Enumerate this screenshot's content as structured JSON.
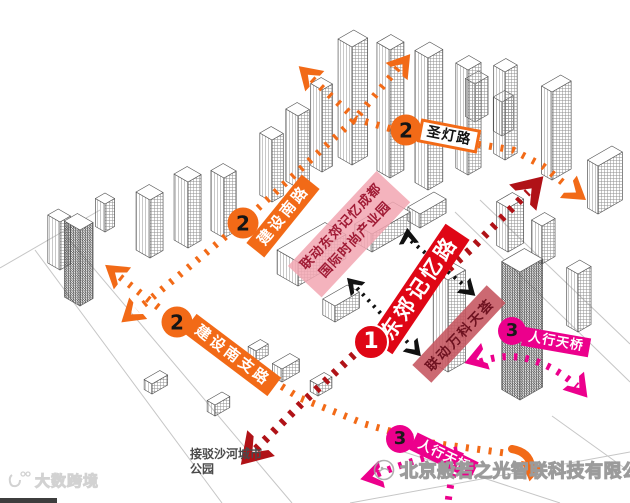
{
  "colors": {
    "orange": "#F26A17",
    "bright_red": "#DF0615",
    "dark_red": "#B01217",
    "magenta": "#EC008C",
    "banner_pink_bg": "#F2A6B1",
    "banner_pink_text": "#A01B35",
    "banner_vanke_bg": "#C5545E",
    "banner_vanke_text": "#6E1220",
    "note_gray": "#4A4A4A",
    "black_route": "#111111"
  },
  "routes": {
    "route1": {
      "number": "1",
      "road_label": "东郊记忆路"
    },
    "route2": {
      "number": "2",
      "roads": {
        "jianshe_south": "建设南路",
        "shengdeng": "圣灯路",
        "jianshe_south_branch": "建设南支路"
      }
    },
    "route3": {
      "number": "3",
      "label": "人行天桥"
    }
  },
  "banners": {
    "dongjiao_park_line1": "联动东郊记忆成都",
    "dongjiao_park_line2": "国际时尚产业园",
    "vanke": "联动万科天荟"
  },
  "notes": {
    "shahe_park": "接驳沙河城市公园"
  },
  "watermarks": {
    "company": "北京般若之光智联科技有限公司",
    "brand": "大数跨境"
  }
}
